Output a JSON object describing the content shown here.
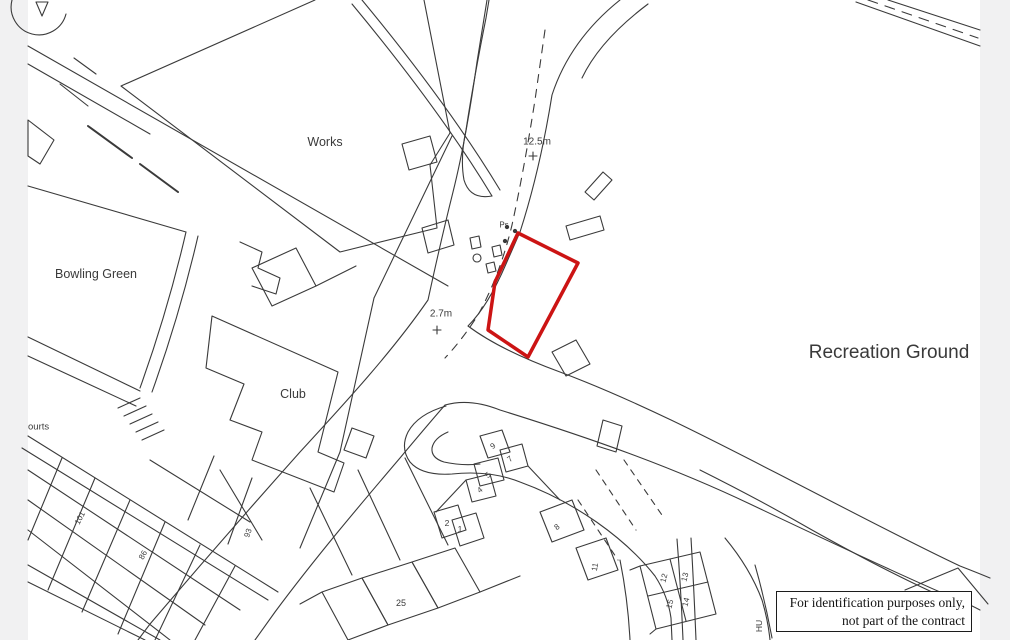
{
  "page": {
    "background_color": "#f1f1f2",
    "sheet_color": "#ffffff",
    "line_color": "#3a3a3a"
  },
  "map": {
    "plot_outline_color": "#cc1414",
    "labels": [
      {
        "id": "works",
        "text": "Works",
        "x": 325,
        "y": 142,
        "size": 12.5,
        "rotate": 0
      },
      {
        "id": "bowling-green",
        "text": "Bowling Green",
        "x": 96,
        "y": 274,
        "size": 12.5,
        "rotate": 0
      },
      {
        "id": "club",
        "text": "Club",
        "x": 293,
        "y": 394,
        "size": 12.5,
        "rotate": 0
      },
      {
        "id": "recreation-ground",
        "text": "Recreation Ground",
        "x": 889,
        "y": 353,
        "size": 19,
        "rotate": 0
      },
      {
        "id": "spot-height-12-5m",
        "text": "12.5m",
        "x": 537,
        "y": 142,
        "size": 10,
        "rotate": 0
      },
      {
        "id": "spot-height-2-7m",
        "text": "2.7m",
        "x": 441,
        "y": 314,
        "size": 10,
        "rotate": 0
      },
      {
        "id": "post-sign-ps",
        "text": "Ps",
        "x": 504,
        "y": 225,
        "size": 8,
        "rotate": 0
      },
      {
        "id": "courts-clipped",
        "text": "ourts",
        "x": 28,
        "y": 427,
        "size": 9.5,
        "rotate": 0,
        "anchor": "left"
      },
      {
        "id": "house-no-101",
        "text": "101",
        "x": 80,
        "y": 518,
        "size": 8,
        "rotate": -62
      },
      {
        "id": "house-no-86",
        "text": "86",
        "x": 143,
        "y": 555,
        "size": 8,
        "rotate": -62
      },
      {
        "id": "house-no-93",
        "text": "93",
        "x": 248,
        "y": 533,
        "size": 8,
        "rotate": -70
      },
      {
        "id": "house-no-9",
        "text": "9",
        "x": 493,
        "y": 446,
        "size": 8,
        "rotate": -38
      },
      {
        "id": "house-no-7",
        "text": "7",
        "x": 510,
        "y": 459,
        "size": 8,
        "rotate": -38
      },
      {
        "id": "house-no-5",
        "text": "5",
        "x": 488,
        "y": 475,
        "size": 8,
        "rotate": -38
      },
      {
        "id": "house-no-4",
        "text": "4",
        "x": 480,
        "y": 490,
        "size": 8,
        "rotate": -38
      },
      {
        "id": "house-no-2",
        "text": "2",
        "x": 447,
        "y": 523,
        "size": 8.5,
        "rotate": 0
      },
      {
        "id": "house-no-1",
        "text": "1",
        "x": 460,
        "y": 529,
        "size": 8.5,
        "rotate": 0
      },
      {
        "id": "house-no-8",
        "text": "8",
        "x": 557,
        "y": 527,
        "size": 8,
        "rotate": -38
      },
      {
        "id": "house-no-11",
        "text": "11",
        "x": 595,
        "y": 567,
        "size": 8,
        "rotate": -80
      },
      {
        "id": "house-no-25",
        "text": "25",
        "x": 401,
        "y": 603,
        "size": 9,
        "rotate": 0
      },
      {
        "id": "house-no-12",
        "text": "12",
        "x": 664,
        "y": 578,
        "size": 8,
        "rotate": -75
      },
      {
        "id": "house-no-13",
        "text": "13",
        "x": 685,
        "y": 577,
        "size": 8,
        "rotate": -75
      },
      {
        "id": "house-no-15",
        "text": "15",
        "x": 670,
        "y": 604,
        "size": 8,
        "rotate": -75
      },
      {
        "id": "house-no-14",
        "text": "14",
        "x": 686,
        "y": 602,
        "size": 8,
        "rotate": -75
      },
      {
        "id": "street-name-hu",
        "text": "HU",
        "x": 759,
        "y": 626,
        "size": 8.5,
        "rotate": -90
      }
    ]
  },
  "disclaimer": {
    "line1": "For identification purposes only,",
    "line2": "not part of the contract"
  }
}
